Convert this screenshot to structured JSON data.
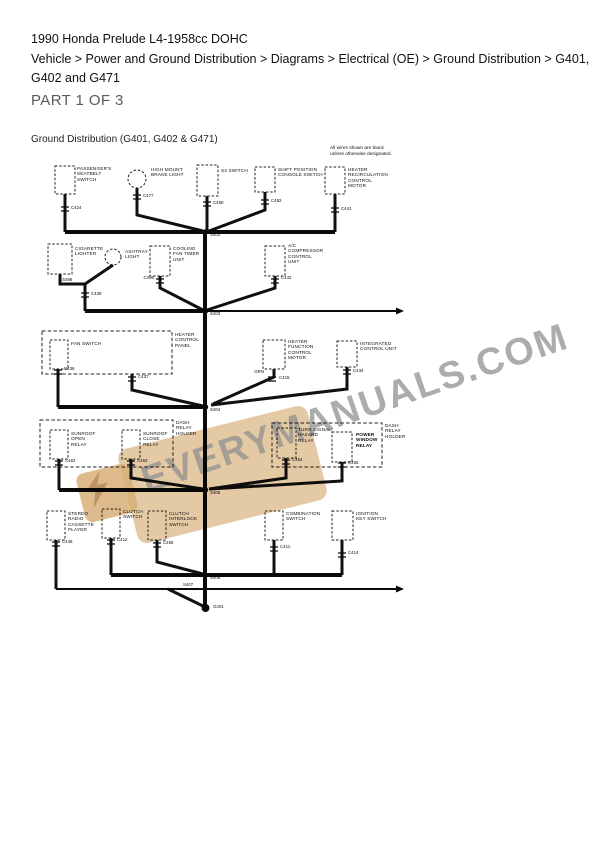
{
  "page": {
    "title": "1990 Honda Prelude L4-1958cc DOHC",
    "breadcrumb": "Vehicle > Power and Ground Distribution > Diagrams > Electrical (OE) > Ground Distribution > G401,\nG402 and G471",
    "part_label": "PART 1 OF 3",
    "diagram_title": "Ground Distribution (G401, G402 & G471)",
    "note": "All wires shown are black\nunless otherwise designated."
  },
  "watermark": {
    "text": "EVERYMANUALS.COM"
  },
  "diagram": {
    "components": {
      "passengers_seatbelt_switch": "PASSENGER'S\nSEATBELT\nSWITCH",
      "high_mount_brake_light": "HIGH MOUNT\nBRAKE LIGHT",
      "s4_switch": "S4 SWITCH",
      "shift_position_console_switch": "SHIFT POSITION\nCONSOLE SWITCH",
      "heater_recirculation_control_motor": "HEATER\nRECIRCULATION\nCONTROL\nMOTOR",
      "cigarette_lighter": "CIGARETTE\nLIGHTER",
      "ashtray_light": "ASHTRAY\nLIGHT",
      "cooling_fan_timer_unit": "COOLING\nFAN TIMER\nUNIT",
      "ac_compressor_control_unit": "A/C\nCOMPRESSOR\nCONTROL\nUNIT",
      "heater_control_panel": "HEATER\nCONTROL\nPANEL",
      "fan_switch": "FAN SWITCH",
      "heater_function_control_motor": "HEATER\nFUNCTION\nCONTROL\nMOTOR",
      "integrated_control_unit": "INTEGRATED\nCONTROL UNIT",
      "dash_relay_holder_left": "DASH\nRELAY\nHOLDER",
      "sunroof_open_relay": "SUNROOF\nOPEN\nRELAY",
      "sunroof_close_relay": "SUNROOF\nCLOSE\nRELAY",
      "turn_signal_hazard_relay": "TURN SIGNAL/\nHAZARD\nRELAY",
      "power_window_relay": "POWER\nWINDOW\nRELAY",
      "dash_relay_holder_right": "DASH\nRELAY\nHOLDER",
      "stereo_radio_cassette_player": "STEREO\nRADIO\nCASSETTE\nPLAYER",
      "clutch_switch": "CLUTCH\nSWITCH",
      "clutch_interlock_switch": "CLUTCH\nINTERLOCK\nSWITCH",
      "combination_switch": "COMBINATION\nSWITCH",
      "ignition_key_switch": "IGNITION\nKEY SWITCH"
    },
    "connectors": {
      "c424": "C424",
      "c477": "C477",
      "c480": "C480",
      "c482": "C482",
      "c441": "C441",
      "c438": "C438",
      "c496": "C496",
      "c442": "C442",
      "c436": "C436",
      "c437": "C437",
      "c415": "C415",
      "c434": "C434",
      "c462": "C462",
      "c463": "C463",
      "c454": "C454",
      "c456": "C456",
      "c448": "C448",
      "c412": "C412",
      "c455": "C455",
      "c411": "C411",
      "c414": "C414"
    },
    "wire_labels": {
      "grn": "GRN"
    },
    "splices": {
      "s498": "S498",
      "s402": "S402",
      "s403": "S403",
      "s404": "S404",
      "s405": "S405",
      "s406": "S406",
      "s407": "S407"
    },
    "grounds": {
      "g401": "G401"
    }
  }
}
